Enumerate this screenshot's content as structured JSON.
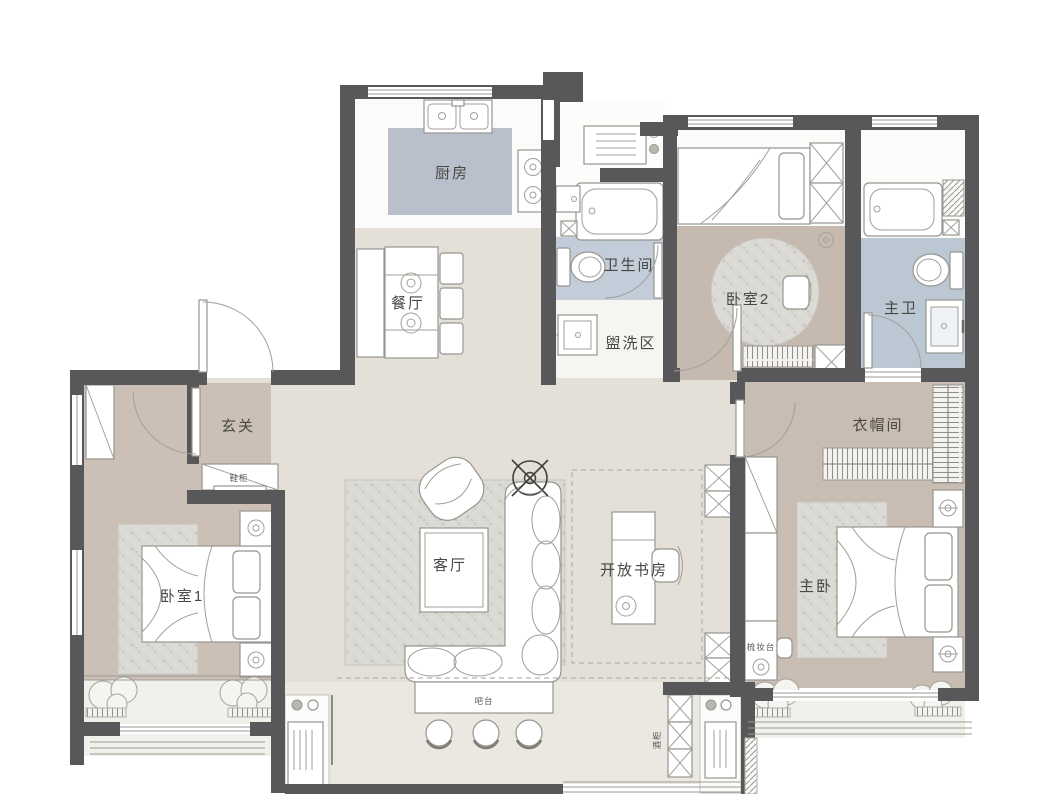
{
  "plan": {
    "type": "apartment-floor-plan",
    "labels": {
      "kitchen": "厨房",
      "dining": "餐厅",
      "bathroom": "卫生间",
      "wash_area": "盥洗区",
      "bedroom2": "卧室2",
      "master_bath": "主卫",
      "entry": "玄关",
      "shoe_cabinet": "鞋柜",
      "cloakroom": "衣帽间",
      "bedroom1": "卧室1",
      "living_room": "客厅",
      "open_study": "开放书房",
      "master_bedroom": "主卧",
      "bar_counter": "吧台",
      "dressing_table": "梳妆台",
      "wine_cabinet": "酒柜"
    },
    "colors": {
      "wall": "#58585A",
      "floor_hall_beige": "#E4E0D7",
      "floor_bedroom_taupe": "#C6BAB0",
      "floor_bath_blue": "#C3CDD9",
      "kitchen_mat_blue": "#B9C0CB",
      "rug_gray": "#DBDAD4",
      "balcony_light": "#F0EFE9"
    }
  }
}
